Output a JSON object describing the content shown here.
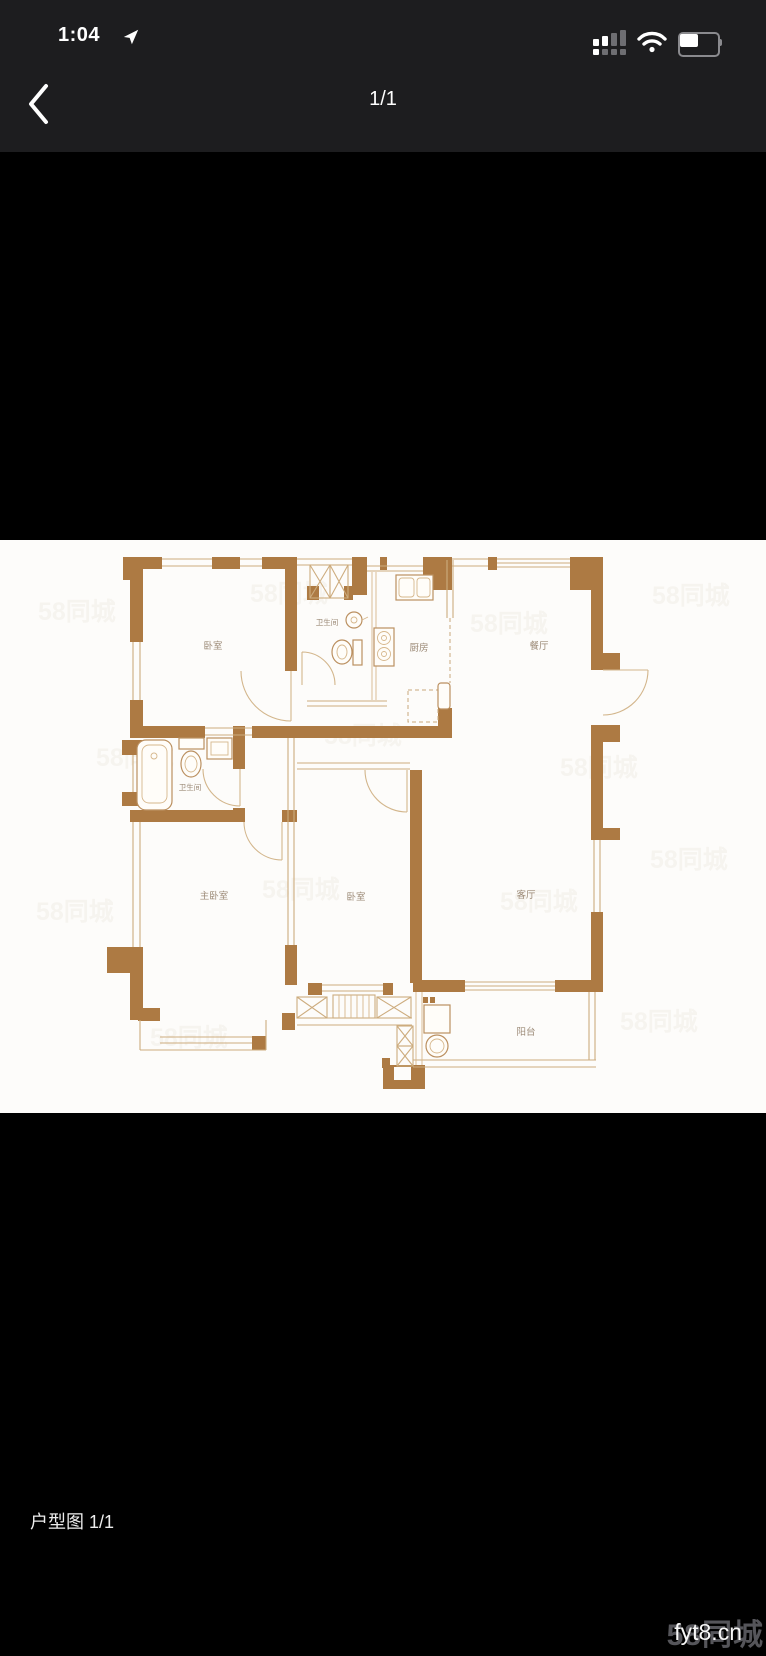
{
  "status_bar": {
    "time": "1:04"
  },
  "nav_bar": {
    "page_indicator": "1/1"
  },
  "photo": {
    "watermark_tile": "58同城",
    "rooms": [
      {
        "id": "bedroom-top",
        "label": "卧室"
      },
      {
        "id": "bathroom-top",
        "label": "卫生间"
      },
      {
        "id": "kitchen",
        "label": "厨房"
      },
      {
        "id": "dining-room",
        "label": "餐厅"
      },
      {
        "id": "bathroom-left",
        "label": "卫生间"
      },
      {
        "id": "master-bedroom",
        "label": "主卧室"
      },
      {
        "id": "bedroom-middle",
        "label": "卧室"
      },
      {
        "id": "living-room",
        "label": "客厅"
      },
      {
        "id": "balcony",
        "label": "阳台"
      }
    ]
  },
  "caption": {
    "text": "户型图 1/1"
  },
  "watermark": {
    "site": "fyt8.cn",
    "logo": "58同城"
  }
}
